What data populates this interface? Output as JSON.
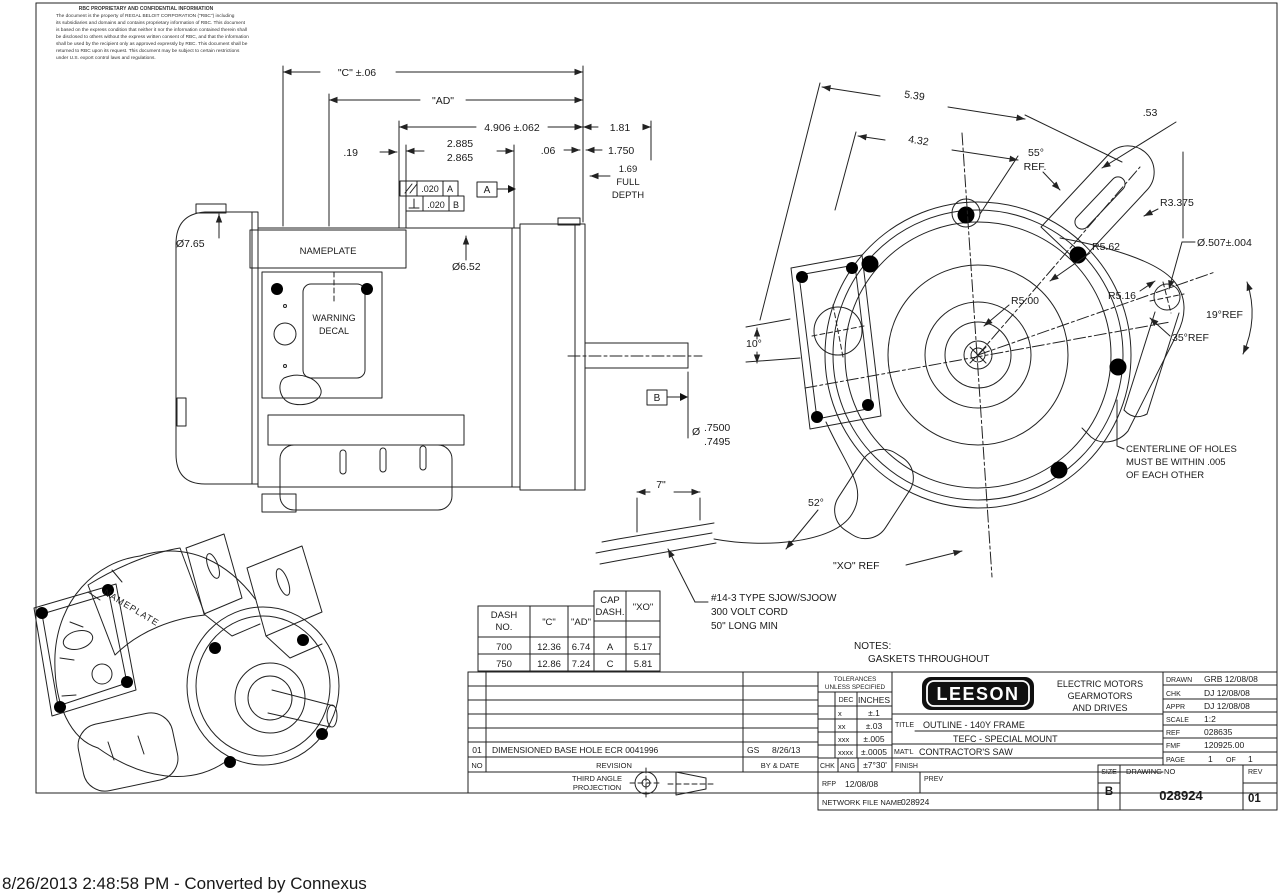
{
  "confidential": {
    "title": "RBC PROPRIETARY AND CONFIDENTIAL INFORMATION",
    "l1": "The document is the property of REGAL BELOIT CORPORATION (\"RBC\") including",
    "l2": "its subsidiaries and domains and contains proprietary information of RBC.  This document",
    "l3": "is based on the express condition that neither it nor the information contained therein shall",
    "l4": "be disclosed to others without the express written consent of RBC, and that the information",
    "l5": "shall be used by the recipient only as approved expressly by RBC.  This document shall be",
    "l6": "returned to RBC upon its request.  This document may be subject to certain restrictions",
    "l7": "under U.S. export control laws and regulations."
  },
  "side_view": {
    "c_dim": "\"C\" ±.06",
    "ad_dim": "\"AD\"",
    "d4906": "4.906 ±.062",
    "d181": "1.81",
    "d019": ".19",
    "d2885": "2.885",
    "d2865": "2.865",
    "d006": ".06",
    "d1750": "1.750",
    "fd1": "1.69",
    "fd2": "FULL",
    "fd3": "DEPTH",
    "fcf1_tol": ".020",
    "fcf1_datum": "A",
    "fcf2_tol": ".020",
    "fcf2_datum": "B",
    "datum_a": "A",
    "datum_b": "B",
    "dia_fan": "Ø7.65",
    "dia_body": "Ø6.52",
    "nameplate": "NAMEPLATE",
    "warn1": "WARNING",
    "warn2": "DECAL",
    "shaft_dia_sym": "Ø",
    "shaft_d1": ".7500",
    "shaft_d2": ".7495"
  },
  "end_view": {
    "d539": "5.39",
    "d432": "4.32",
    "d053": ".53",
    "a55": "55°",
    "a55ref": "REF.",
    "r3375": "R3.375",
    "hole_dia": "Ø.507±.004",
    "r562": "R5.62",
    "r516": "R5.16",
    "r500": "R5.00",
    "a19": "19°REF",
    "a35": "35°REF",
    "a10": "10°",
    "a52": "52°",
    "xo_ref": "\"XO\" REF",
    "d7": "7\"",
    "cl1": "CENTERLINE OF HOLES",
    "cl2": "MUST BE WITHIN .005",
    "cl3": "OF EACH OTHER"
  },
  "cord_note": {
    "l1": "#14-3 TYPE SJOW/SJOOW",
    "l2": "300 VOLT CORD",
    "l3": "50\" LONG MIN"
  },
  "notes": {
    "label": "NOTES:",
    "item1": "GASKETS THROUGHOUT"
  },
  "iso_view": {
    "nameplate": "NAMEPLATE"
  },
  "dash_table": {
    "h_dash1": "DASH",
    "h_dash2": "NO.",
    "h_c": "\"C\"",
    "h_ad": "\"AD\"",
    "h_cap1": "CAP",
    "h_cap2": "DASH.",
    "h_xo": "\"XO\"",
    "cap_a": "A",
    "xo_a": "5.17",
    "rows": [
      {
        "dash": "700",
        "c": "12.36",
        "ad": "6.74",
        "cap": "B",
        "xo": "5.55"
      },
      {
        "dash": "750",
        "c": "12.86",
        "ad": "7.24",
        "cap": "C",
        "xo": "5.81"
      }
    ]
  },
  "title_block": {
    "revision": {
      "no": "01",
      "desc": "DIMENSIONED BASE HOLE ECR 0041996",
      "by": "GS",
      "by_date": "8/26/13",
      "no_h": "NO",
      "rev_h": "REVISION",
      "by_h": "BY & DATE"
    },
    "projection": {
      "line1": "THIRD ANGLE",
      "line2": "PROJECTION"
    },
    "tol": {
      "h1": "TOLERANCES",
      "h2": "UNLESS SPECIFIED",
      "dec": "DEC",
      "inches": "INCHES",
      "r1l": "x",
      "r1v": "±.1",
      "r2l": "xx",
      "r2v": "±.03",
      "r3l": "xxx",
      "r3v": "±.005",
      "r4l": "xxxx",
      "r4v": "±.0005",
      "chk": "CHK",
      "ang": "ANG",
      "angv": "±7°30'"
    },
    "brand": {
      "logo": "LEESON",
      "t1": "ELECTRIC MOTORS",
      "t2": "GEARMOTORS",
      "t3": "AND DRIVES"
    },
    "title": {
      "label": "TITLE",
      "line1": "OUTLINE - 140Y FRAME",
      "line2": "TEFC - SPECIAL MOUNT"
    },
    "matl": {
      "label": "MAT'L",
      "value": "CONTRACTOR'S SAW"
    },
    "finish": {
      "label": "FINISH"
    },
    "rfp": {
      "label": "RFP",
      "value": "12/08/08"
    },
    "prev": {
      "label": "PREV"
    },
    "network": {
      "label": "NETWORK FILE NAME",
      "value": "028924"
    },
    "drawn": {
      "label": "DRAWN",
      "value": "GRB 12/08/08"
    },
    "chk": {
      "label": "CHK",
      "value": "DJ 12/08/08"
    },
    "appr": {
      "label": "APPR",
      "value": "DJ 12/08/08"
    },
    "scale": {
      "label": "SCALE",
      "value": "1:2"
    },
    "ref": {
      "label": "REF",
      "value": "028635"
    },
    "fmf": {
      "label": "FMF",
      "value": "120925.00"
    },
    "page": {
      "label": "PAGE",
      "v1": "1",
      "of": "OF",
      "v2": "1"
    },
    "size": {
      "label": "SIZE",
      "value": "B"
    },
    "drawing_no": {
      "label": "DRAWING NO",
      "value": "028924"
    },
    "rev": {
      "label": "REV",
      "value": "01"
    }
  },
  "footer": "8/26/2013 2:48:58 PM - Converted by Connexus"
}
